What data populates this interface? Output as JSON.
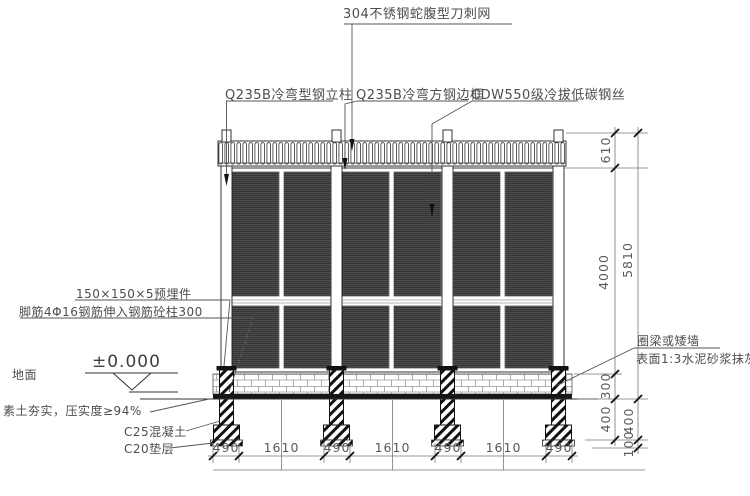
{
  "labels": {
    "razor_wire": "304不锈钢蛇腹型刀刺网",
    "post": "Q235B冷弯型钢立柱",
    "frame": "Q235B冷弯方钢边框",
    "wire": "CDW550级冷拔低碳钢丝",
    "embed_plate": "150×150×5预埋件",
    "anchor_bars": "脚筋4Φ16钢筋伸入钢筋砼柱300",
    "level": "±0.000",
    "ground": "地面",
    "soil": "素土夯实，压实度≥94%",
    "concrete": "C25混凝土",
    "cushion": "C20垫层",
    "ring_beam": "圈梁或矮墙",
    "surface": "表面1:3水泥砂浆抹灰"
  },
  "dimensions": {
    "vertical": {
      "razor_height": "610",
      "mesh_height": "4000",
      "total_height": "5810",
      "wall_upper": "300",
      "wall_lower": "400",
      "footing_depth": "400",
      "cushion_thickness": "100"
    },
    "horizontal": [
      "490",
      "1610",
      "490",
      "1610",
      "490",
      "1610",
      "490"
    ]
  },
  "colors": {
    "line": "#3c3c3c",
    "dim": "#666666",
    "heavy": "#111111",
    "text": "#4d4d4d"
  }
}
